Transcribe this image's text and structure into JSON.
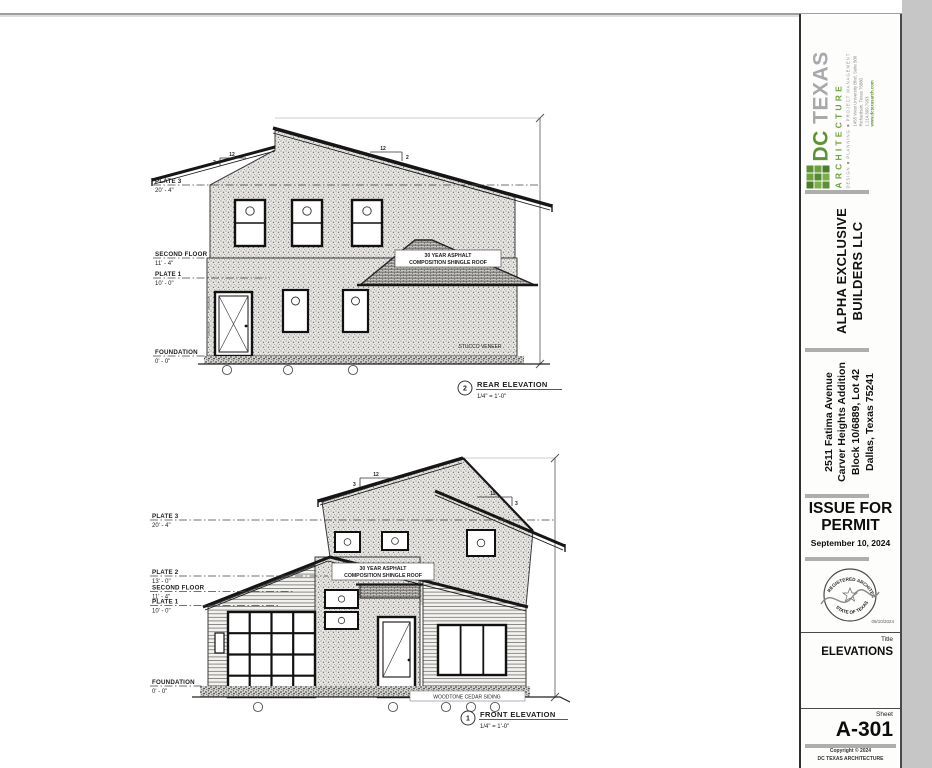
{
  "firm": {
    "abbr": "DC",
    "name": "TEXAS",
    "division": "ARCHITECTURE",
    "tagline": "DESIGN ■ PLANNING ■ PROJECT MANAGEMENT",
    "contact_line1": "1455 West University Blvd, Suite 500",
    "contact_line2": "Richardson, Texas 75080",
    "contact_line3": "1.214.699.7963",
    "contact_line4": "www.dctexasarch.com"
  },
  "client": {
    "line1": "ALPHA EXCLUSIVE",
    "line2": "BUILDERS LLC"
  },
  "project": {
    "line1": "2511 Fatima Avenue",
    "line2": "Carver Heights Addition",
    "line3": "Block 10/6889, Lot 42",
    "line4": "Dallas, Texas 75241"
  },
  "issue": {
    "line1": "ISSUE FOR",
    "line2": "PERMIT",
    "date": "September 10, 2024"
  },
  "seal": {
    "arc_top": "REGISTERED ARCHITECT",
    "arc_bottom": "STATE OF TEXAS",
    "date": "09/10/2024"
  },
  "titleblock": {
    "title_label": "Title",
    "title": "ELEVATIONS",
    "sheet_label": "Sheet",
    "sheet_number": "A-301",
    "copyright_line1": "Copyright © 2024",
    "copyright_line2": "DC TEXAS ARCHITECTURE"
  },
  "drawings": {
    "rear": {
      "number": "2",
      "title": "REAR ELEVATION",
      "scale": "1/4\" = 1'-0\"",
      "levels": [
        {
          "label": "PLATE 3",
          "value": "20' - 4\""
        },
        {
          "label": "SECOND FLOOR",
          "value": "11' - 4\""
        },
        {
          "label": "PLATE 1",
          "value": "10' - 0\""
        },
        {
          "label": "FOUNDATION",
          "value": "0' - 0\""
        }
      ],
      "roof_note_1": "30 YEAR ASPHALT",
      "roof_note_2": "COMPOSITION SHINGLE ROOF",
      "wall_note": "STUCCO VENEER",
      "slope_run": "12",
      "slope_rise": "2"
    },
    "front": {
      "number": "1",
      "title": "FRONT ELEVATION",
      "scale": "1/4\" = 1'-0\"",
      "levels": [
        {
          "label": "PLATE 3",
          "value": "20' - 4\""
        },
        {
          "label": "PLATE 2",
          "value": "13' - 0\""
        },
        {
          "label": "SECOND FLOOR",
          "value": "11' - 4\""
        },
        {
          "label": "PLATE 1",
          "value": "10' - 0\""
        },
        {
          "label": "FOUNDATION",
          "value": "0' - 0\""
        }
      ],
      "roof_note_1": "30 YEAR ASPHALT",
      "roof_note_2": "COMPOSITION SHINGLE ROOF",
      "siding_note": "WOODTONE CEDAR SIDING",
      "slope_run": "12",
      "slope_rise": "3"
    }
  }
}
